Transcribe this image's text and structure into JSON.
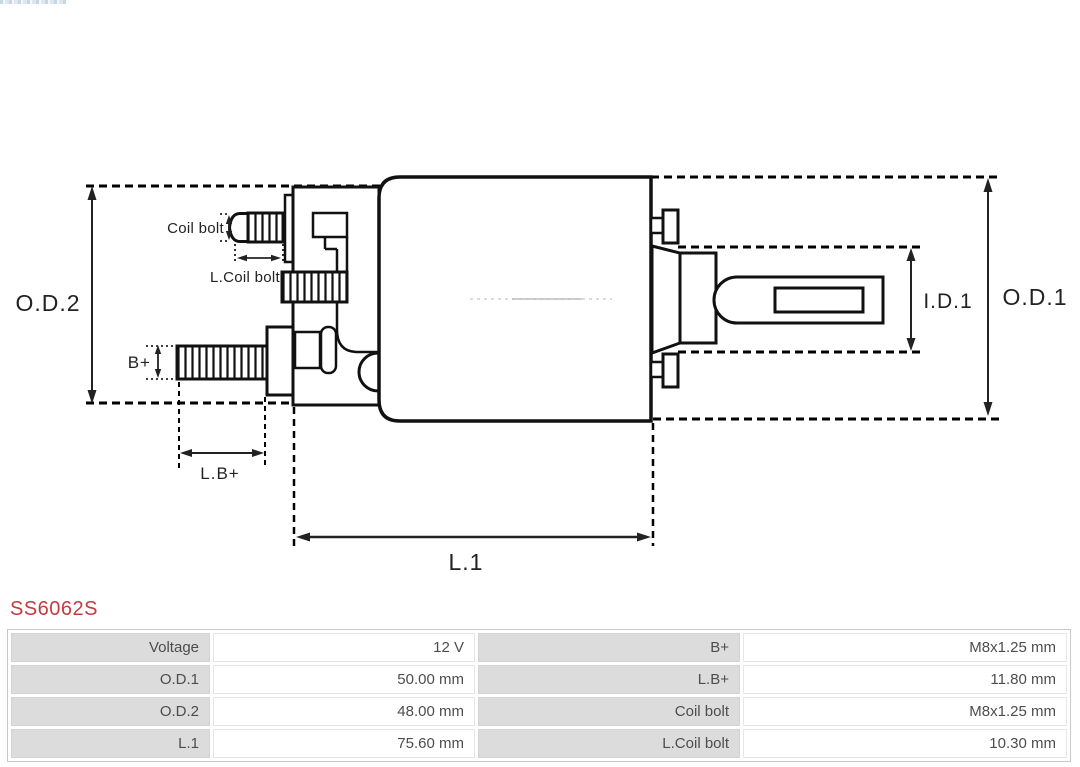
{
  "part_number": "SS6062S",
  "diagram": {
    "labels": {
      "od2": "O.D.2",
      "od1": "O.D.1",
      "id1": "I.D.1",
      "l1": "L.1",
      "b_plus": "B+",
      "l_b_plus": "L.B+",
      "coil_bolt": "Coil bolt",
      "l_coil_bolt": "L.Coil bolt"
    }
  },
  "spec_table": {
    "rows": [
      {
        "label1": "Voltage",
        "value1": "12 V",
        "label2": "B+",
        "value2": "M8x1.25 mm"
      },
      {
        "label1": "O.D.1",
        "value1": "50.00 mm",
        "label2": "L.B+",
        "value2": "11.80 mm"
      },
      {
        "label1": "O.D.2",
        "value1": "48.00 mm",
        "label2": "Coil bolt",
        "value2": "M8x1.25 mm"
      },
      {
        "label1": "L.1",
        "value1": "75.60 mm",
        "label2": "L.Coil bolt",
        "value2": "10.30 mm"
      }
    ]
  },
  "colors": {
    "part_number_red": "#c43a3e",
    "table_label_bg": "#dcdcdc",
    "table_border": "#c9c9c9",
    "table_text": "#4d4d4d",
    "diagram_stroke": "#111111"
  }
}
